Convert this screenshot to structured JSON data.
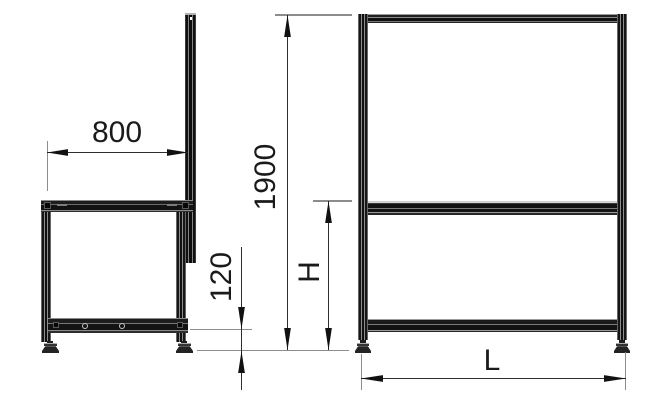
{
  "dimensions": {
    "depth": {
      "label": "800"
    },
    "total_height": {
      "label": "1900"
    },
    "base_height": {
      "label": "120"
    },
    "height_var": {
      "label": "H"
    },
    "length_var": {
      "label": "L"
    }
  },
  "colors": {
    "background": "#ffffff",
    "frame": "#161616",
    "extension_line": "#8c8c8c",
    "dimension_line": "#2e2e2e",
    "arrow": "#111111",
    "text": "#1a1a1a"
  }
}
